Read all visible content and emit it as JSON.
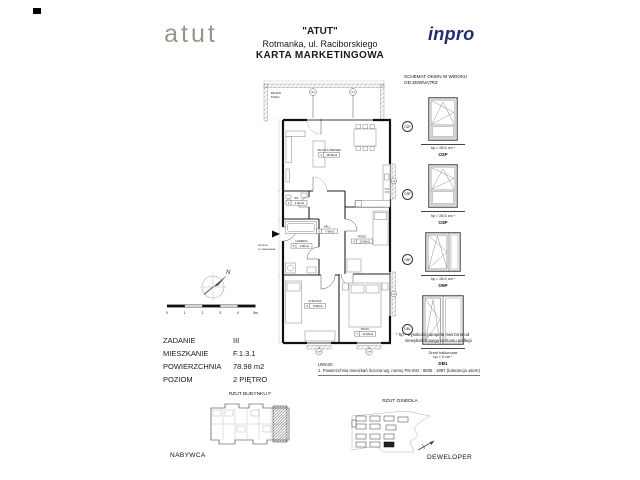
{
  "colors": {
    "inpro_navy": "#1e2d7b",
    "atut_gray": "#98958c",
    "line_dark": "#111111"
  },
  "header": {
    "brand_left": "atut",
    "title": "\"ATUT\"",
    "subtitle": "Rotmanka, ul. Raciborskiego",
    "doc_type": "KARTA MARKETINGOWA",
    "brand_right": "inpro"
  },
  "plan": {
    "balcony_name": "BALKON",
    "balcony_area": "8.53m2",
    "entrance_line1": "WEJŚCIE",
    "entrance_line2": "DO MIESZKANIA",
    "rooms": [
      {
        "num": "1",
        "name": "SALON Z ANEKSEM",
        "area": "28.06m2"
      },
      {
        "num": "2",
        "name": "WC",
        "area": "2.30m2"
      },
      {
        "num": "3",
        "name": "HALL",
        "area": "7.96m2"
      },
      {
        "num": "4",
        "name": "POKÓJ",
        "area": "12.80m2"
      },
      {
        "num": "5",
        "name": "ŁAZIENKA",
        "area": "4.90m2"
      },
      {
        "num": "6",
        "name": "SYPIALNIA",
        "area": "8.96m2"
      },
      {
        "num": "7",
        "name": "POKÓJ",
        "area": "14.00m2"
      }
    ],
    "markers": [
      "DB1",
      "O2P",
      "O3P",
      "O5P",
      "O3P",
      "O5P"
    ]
  },
  "windows_panel": {
    "title_line1": "SCHEMAT OKIEN W WIDOKU",
    "title_line2": "OD ZEWNĄTRZ",
    "items": [
      {
        "code": "O2P",
        "caption": "hp = 28.5 cm *"
      },
      {
        "code": "O3P",
        "caption": "hp = 28.5 cm *"
      },
      {
        "code": "O5P",
        "caption": "hp = 28.5 cm *"
      },
      {
        "code": "DB1",
        "caption": "Drzwi balkonowe",
        "caption2": "hp = 0 cm *"
      }
    ]
  },
  "info_table": {
    "rows": [
      {
        "label": "ZADANIE",
        "value": "III"
      },
      {
        "label": "MIESZKANIE",
        "value": "F.1.3.1"
      },
      {
        "label": "POWIERZCHNIA",
        "value": "78.98 m2"
      },
      {
        "label": "POZIOM",
        "value": "2 PIĘTRO"
      }
    ]
  },
  "notes": {
    "footnote_line1": "* hp - wysokość parapetu mierzona od",
    "footnote_line2": "niewykończonego poziomu podłogi",
    "uwagi_label": "UWAGI:",
    "uwagi_text": "1. Powierzchnia mieszkań liczona wg. normy  PN-ISO : 9836 : 1997 (tolerancja ±5cm)"
  },
  "scale_bar": {
    "labels": [
      "0",
      "1",
      "2",
      "3",
      "4",
      "5m"
    ]
  },
  "compass": {
    "north_label": "N"
  },
  "bottom": {
    "building_plan_title": "RZUT BUDYNKU F",
    "site_plan_title": "RZUT OSIEDLA",
    "buyer_label": "NABYWCA",
    "developer_label": "DEWELOPER"
  }
}
